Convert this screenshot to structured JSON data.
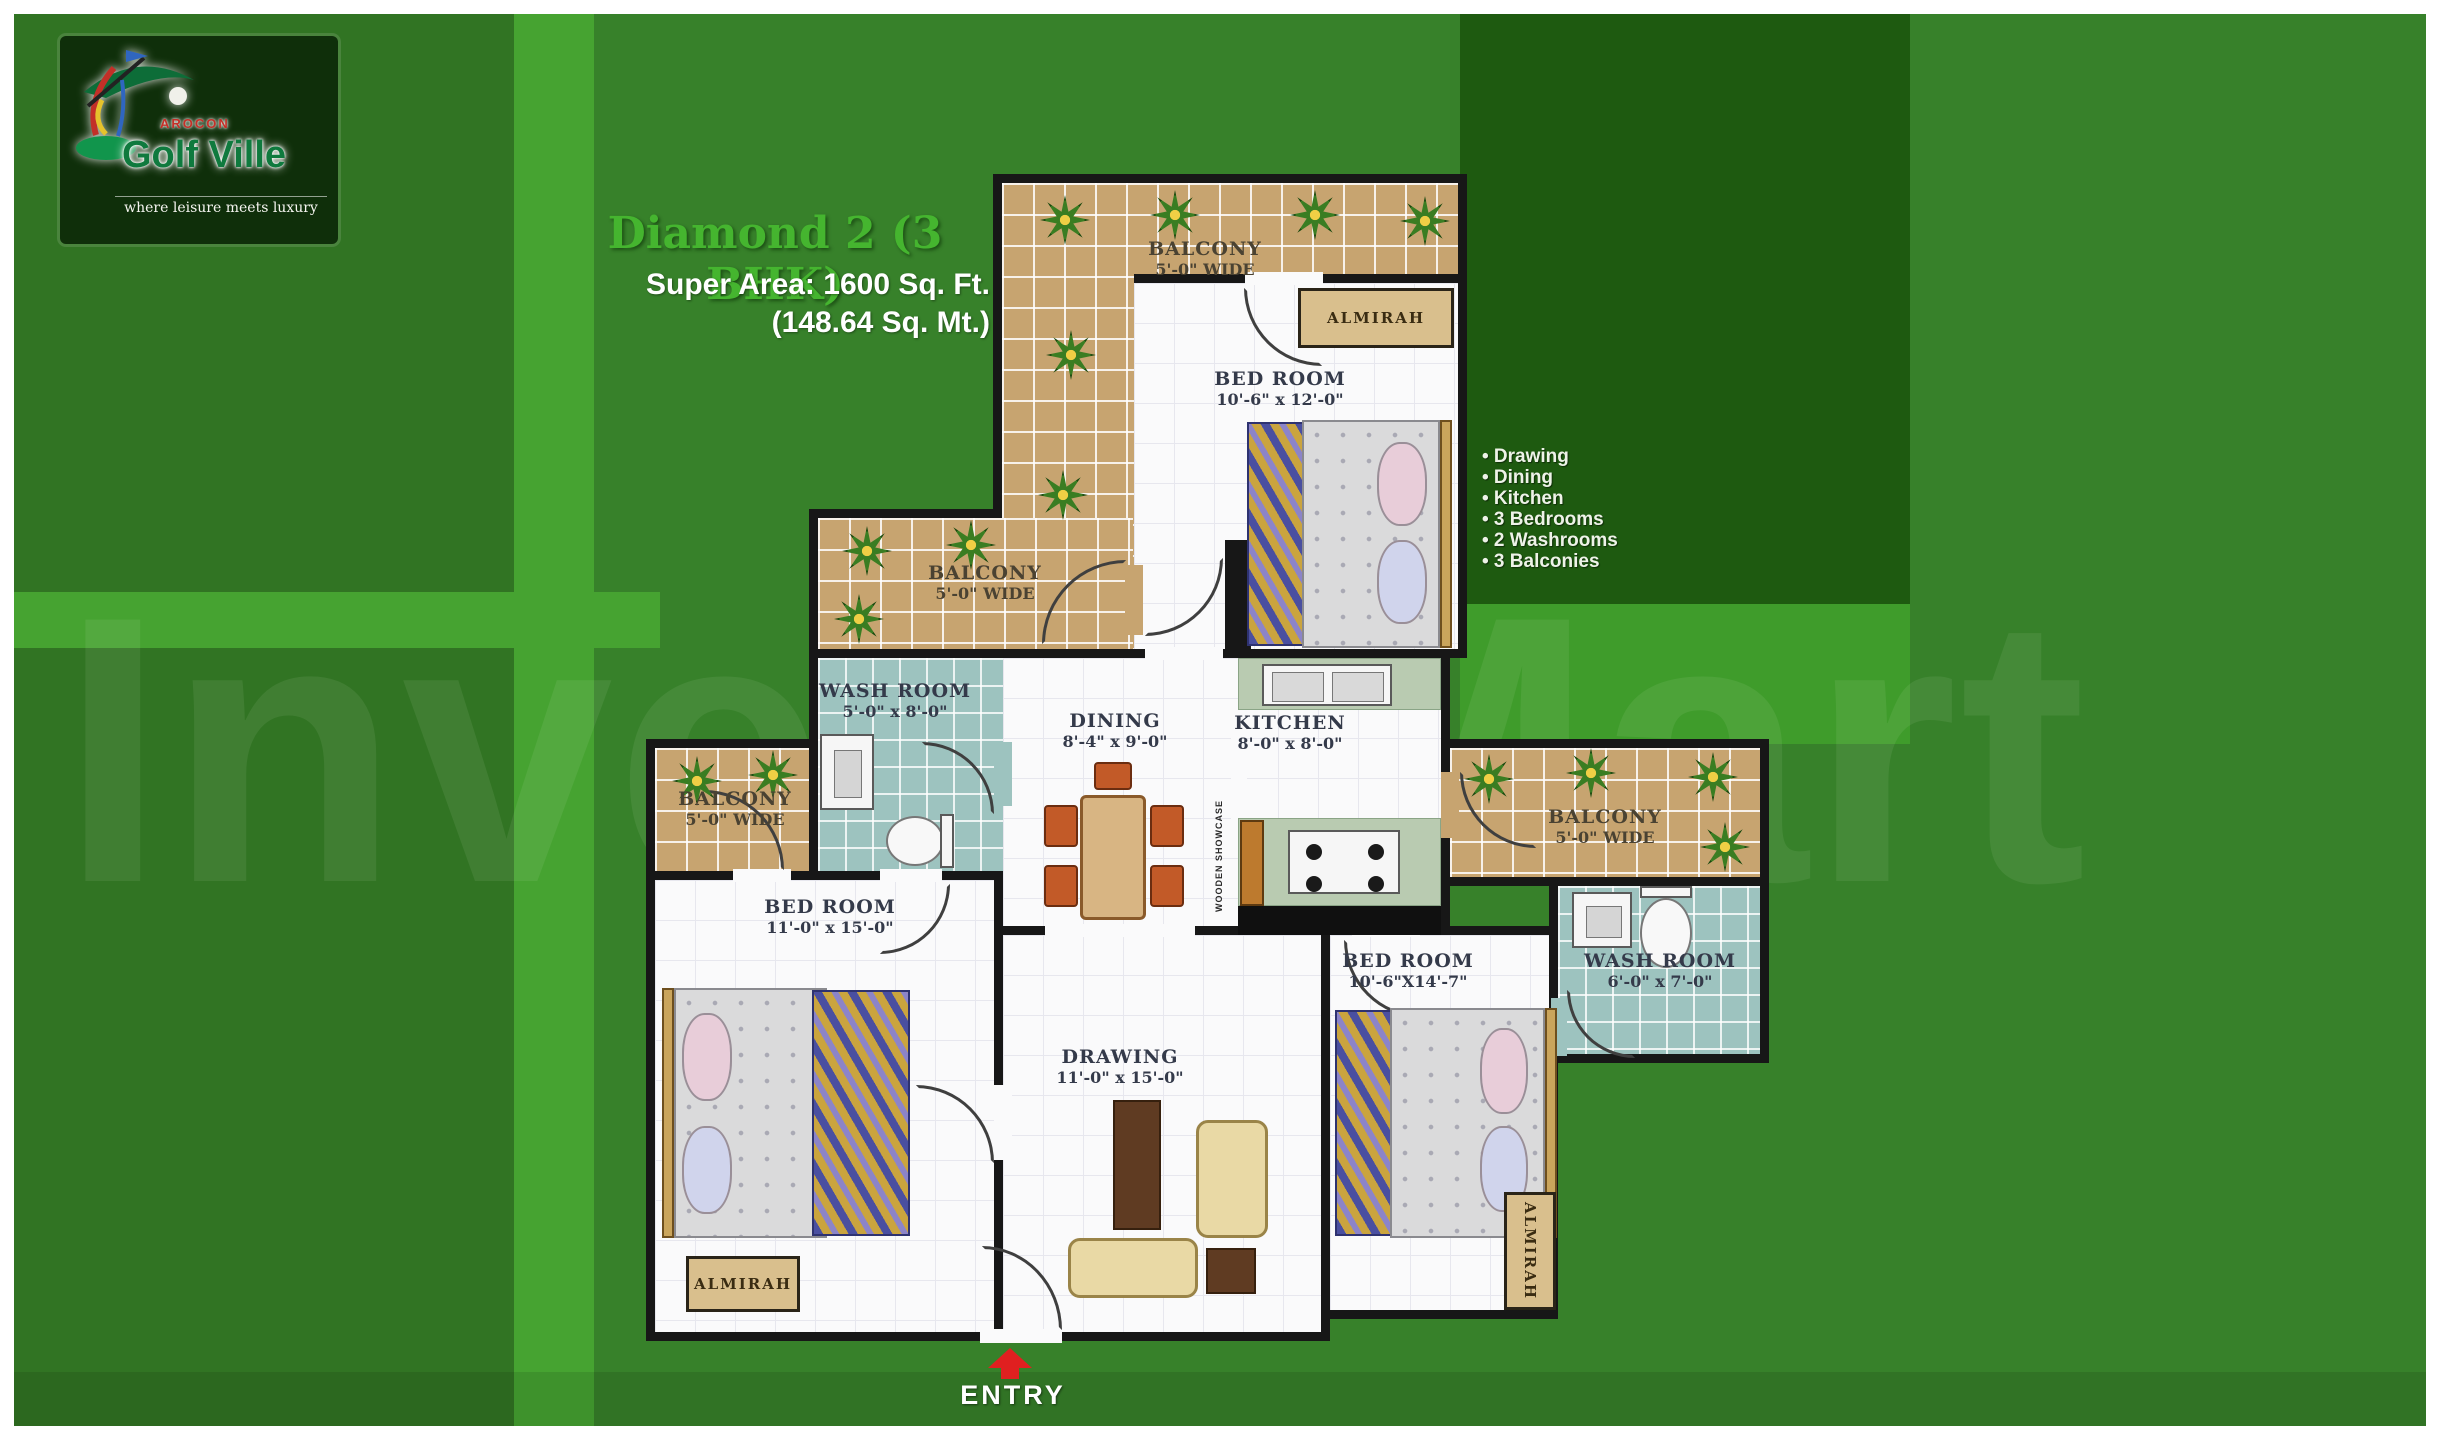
{
  "logo": {
    "brand_top": "AROCON",
    "brand": "Golf Ville",
    "tagline": "where leisure meets luxury"
  },
  "header": {
    "title": "Diamond 2 (3 BHK)",
    "area_line1": "Super Area: 1600 Sq. Ft.",
    "area_line2": "(148.64 Sq. Mt.)"
  },
  "features": {
    "items": [
      "• Drawing",
      "• Dining",
      "• Kitchen",
      "• 3 Bedrooms",
      "• 2 Washrooms",
      "• 3 Balconies"
    ]
  },
  "watermark": "Invest Mart",
  "entry": {
    "label": "ENTRY"
  },
  "rooms": {
    "balcony_top": {
      "name": "BALCONY",
      "dim": "5'-0\" WIDE"
    },
    "balcony_mid": {
      "name": "BALCONY",
      "dim": "5'-0\" WIDE"
    },
    "balcony_left": {
      "name": "BALCONY",
      "dim": "5'-0\" WIDE"
    },
    "balcony_right": {
      "name": "BALCONY",
      "dim": "5'-0\" WIDE"
    },
    "bedroom_top": {
      "name": "BED ROOM",
      "dim": "10'-6\" x 12'-0\""
    },
    "bedroom_left": {
      "name": "BED ROOM",
      "dim": "11'-0\" x 15'-0\""
    },
    "bedroom_right": {
      "name": "BED ROOM",
      "dim": "10'-6\"X14'-7\""
    },
    "washroom_mid": {
      "name": "WASH ROOM",
      "dim": "5'-0\" x 8'-0\""
    },
    "washroom_right": {
      "name": "WASH ROOM",
      "dim": "6'-0\" x 7'-0\""
    },
    "dining": {
      "name": "DINING",
      "dim": "8'-4\" x 9'-0\""
    },
    "kitchen": {
      "name": "KITCHEN",
      "dim": "8'-0\" x 8'-0\""
    },
    "drawing": {
      "name": "DRAWING",
      "dim": "11'-0\" x 15'-0\""
    },
    "almirah_top": "ALMIRAH",
    "almirah_left": "ALMIRAH",
    "almirah_right": "ALMIRAH",
    "wooden_showcase": "WOODEN SHOWCASE"
  },
  "colors": {
    "canvas_green": "#37812a",
    "dark_panel": "#1e5a10",
    "bright_green": "#46a331",
    "title_green": "#45b52f",
    "entry_red": "#e02020"
  }
}
